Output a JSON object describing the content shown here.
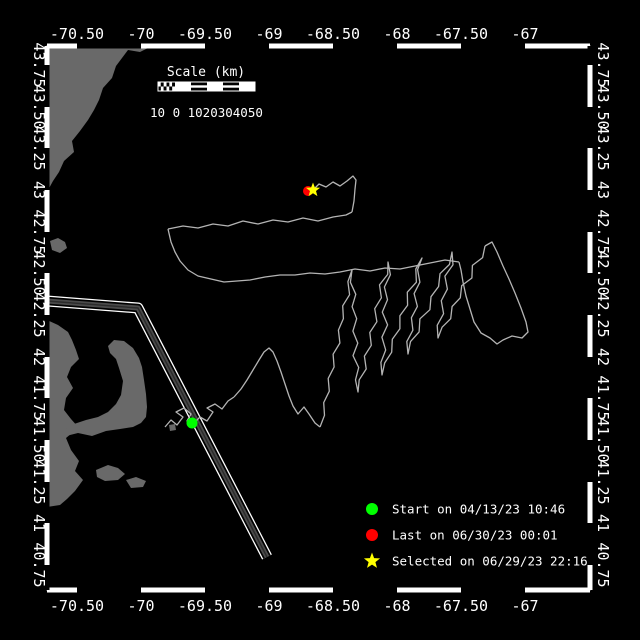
{
  "window": {
    "width": 640,
    "height": 640,
    "background": "#000000"
  },
  "frame": {
    "left": 47,
    "top": 46,
    "right": 590,
    "bottom": 590,
    "line_color": "#ffffff",
    "zebra_thickness": 5
  },
  "axes": {
    "lon_labels": [
      {
        "text": "-70.50",
        "x": 77
      },
      {
        "text": "-70",
        "x": 141
      },
      {
        "text": "-69.50",
        "x": 205
      },
      {
        "text": "-69",
        "x": 269
      },
      {
        "text": "-68.50",
        "x": 333
      },
      {
        "text": "-68",
        "x": 397
      },
      {
        "text": "-67.50",
        "x": 461
      },
      {
        "text": "-67",
        "x": 525
      }
    ],
    "lon_boundaries": [
      47,
      77,
      141,
      205,
      269,
      333,
      397,
      461,
      525,
      590
    ],
    "top_label_y": 39,
    "bottom_label_y": 611,
    "lat_labels": [
      {
        "text": "43.75",
        "y": 65
      },
      {
        "text": "43.50",
        "y": 107
      },
      {
        "text": "43.25",
        "y": 148
      },
      {
        "text": "43",
        "y": 190
      },
      {
        "text": "42.75",
        "y": 232
      },
      {
        "text": "42.50",
        "y": 273
      },
      {
        "text": "42.25",
        "y": 315
      },
      {
        "text": "42",
        "y": 357
      },
      {
        "text": "41.75",
        "y": 398
      },
      {
        "text": "41.50",
        "y": 440
      },
      {
        "text": "41.25",
        "y": 482
      },
      {
        "text": "41",
        "y": 523
      },
      {
        "text": "40.75",
        "y": 565
      }
    ],
    "lat_boundaries": [
      46,
      65,
      107,
      148,
      190,
      232,
      273,
      315,
      357,
      398,
      440,
      482,
      523,
      565,
      590
    ],
    "left_label_x": 34,
    "right_label_x": 598
  },
  "scalebar": {
    "title": "Scale (km)",
    "title_x": 206,
    "title_y": 76,
    "numbers": "10 0 1020304050",
    "numbers_x": 150,
    "numbers_y": 117,
    "x": 158,
    "y": 82,
    "width": 97,
    "height": 9,
    "checker_width": 17
  },
  "legend": {
    "marker_x": 372,
    "text_x": 392,
    "items": [
      {
        "marker": "circle",
        "color": "#00ff00",
        "label": "Start on 04/13/23 10:46",
        "y": 509
      },
      {
        "marker": "circle",
        "color": "#ff0000",
        "label": "Last on 06/30/23 00:01",
        "y": 535
      },
      {
        "marker": "star",
        "color": "#ffff00",
        "label": "Selected on 06/29/23 22:16",
        "y": 561
      }
    ]
  },
  "map": {
    "land_color": "#696969",
    "land_polygons": [
      [
        [
          47,
          46
        ],
        [
          152,
          46
        ],
        [
          140,
          52
        ],
        [
          128,
          50
        ],
        [
          122,
          58
        ],
        [
          116,
          66
        ],
        [
          112,
          78
        ],
        [
          103,
          88
        ],
        [
          99,
          100
        ],
        [
          94,
          110
        ],
        [
          88,
          120
        ],
        [
          80,
          131
        ],
        [
          72,
          141
        ],
        [
          74,
          152
        ],
        [
          64,
          161
        ],
        [
          59,
          172
        ],
        [
          53,
          181
        ],
        [
          47,
          192
        ]
      ],
      [
        [
          50,
          241
        ],
        [
          58,
          238
        ],
        [
          65,
          242
        ],
        [
          67,
          248
        ],
        [
          60,
          253
        ],
        [
          52,
          250
        ]
      ],
      [
        [
          47,
          320
        ],
        [
          58,
          325
        ],
        [
          68,
          332
        ],
        [
          72,
          340
        ],
        [
          76,
          350
        ],
        [
          79,
          359
        ],
        [
          71,
          367
        ],
        [
          67,
          377
        ],
        [
          73,
          388
        ],
        [
          66,
          398
        ],
        [
          64,
          410
        ],
        [
          71,
          419
        ],
        [
          79,
          428
        ],
        [
          72,
          433
        ],
        [
          66,
          438
        ],
        [
          71,
          450
        ],
        [
          79,
          461
        ],
        [
          75,
          471
        ],
        [
          83,
          480
        ],
        [
          75,
          491
        ],
        [
          67,
          499
        ],
        [
          60,
          505
        ],
        [
          47,
          507
        ]
      ],
      [
        [
          66,
          436
        ],
        [
          78,
          433
        ],
        [
          92,
          436
        ],
        [
          106,
          431
        ],
        [
          120,
          429
        ],
        [
          133,
          427
        ],
        [
          141,
          423
        ],
        [
          146,
          417
        ],
        [
          147,
          407
        ],
        [
          146,
          394
        ],
        [
          144,
          380
        ],
        [
          142,
          367
        ],
        [
          139,
          358
        ],
        [
          133,
          348
        ],
        [
          124,
          341
        ],
        [
          114,
          340
        ],
        [
          108,
          346
        ],
        [
          110,
          353
        ],
        [
          116,
          359
        ],
        [
          119,
          368
        ],
        [
          123,
          381
        ],
        [
          121,
          395
        ],
        [
          116,
          404
        ],
        [
          108,
          412
        ],
        [
          98,
          417
        ],
        [
          86,
          420
        ],
        [
          74,
          424
        ],
        [
          66,
          429
        ]
      ],
      [
        [
          96,
          470
        ],
        [
          108,
          465
        ],
        [
          118,
          468
        ],
        [
          125,
          474
        ],
        [
          118,
          480
        ],
        [
          105,
          481
        ],
        [
          97,
          477
        ]
      ],
      [
        [
          126,
          480
        ],
        [
          136,
          477
        ],
        [
          146,
          481
        ],
        [
          143,
          487
        ],
        [
          131,
          488
        ]
      ],
      [
        [
          169,
          425
        ],
        [
          175,
          424
        ],
        [
          176,
          430
        ],
        [
          170,
          431
        ]
      ]
    ],
    "shipping_lane": {
      "points": [
        [
          47,
          301
        ],
        [
          138,
          308
        ],
        [
          267,
          557
        ]
      ],
      "edge_color": "#ffffff",
      "fill_color": "#4a4a4a",
      "core_color": "#2b2b2b"
    },
    "markers": {
      "start": {
        "x": 192,
        "y": 423,
        "color": "#00ff00",
        "r": 5.5
      },
      "last": {
        "x": 308,
        "y": 191,
        "color": "#ff0000",
        "r": 5
      },
      "selected": {
        "x": 313,
        "y": 190,
        "color": "#ffff00",
        "r": 7.5
      }
    }
  },
  "track": {
    "color": "#b4b4b4",
    "width": 1.3,
    "segments": [
      {
        "amp": 2,
        "step": 9,
        "points": [
          [
            165,
            427
          ],
          [
            171,
            420
          ],
          [
            177,
            425
          ],
          [
            183,
            417
          ],
          [
            176,
            412
          ],
          [
            184,
            408
          ],
          [
            191,
            414
          ],
          [
            187,
            421
          ],
          [
            193,
            424
          ],
          [
            200,
            417
          ],
          [
            207,
            421
          ],
          [
            213,
            412
          ],
          [
            207,
            408
          ],
          [
            215,
            404
          ],
          [
            222,
            409
          ],
          [
            228,
            401
          ],
          [
            234,
            397
          ]
        ]
      },
      {
        "amp": 2,
        "step": 11,
        "points": [
          [
            234,
            397
          ],
          [
            241,
            389
          ],
          [
            247,
            380
          ],
          [
            253,
            370
          ],
          [
            259,
            360
          ],
          [
            264,
            352
          ],
          [
            269,
            348
          ],
          [
            273,
            352
          ],
          [
            277,
            361
          ],
          [
            281,
            372
          ],
          [
            285,
            384
          ],
          [
            289,
            396
          ],
          [
            293,
            406
          ],
          [
            298,
            414
          ],
          [
            304,
            407
          ],
          [
            309,
            414
          ],
          [
            315,
            423
          ],
          [
            320,
            427
          ]
        ]
      },
      {
        "amp": 2.5,
        "step": 12,
        "points": [
          [
            320,
            427
          ],
          [
            352,
            270
          ],
          [
            358,
            392
          ],
          [
            388,
            262
          ],
          [
            382,
            375
          ],
          [
            422,
            258
          ],
          [
            408,
            354
          ],
          [
            452,
            252
          ],
          [
            438,
            338
          ],
          [
            485,
            246
          ]
        ]
      },
      {
        "amp": 2.5,
        "step": 12,
        "points": [
          [
            485,
            246
          ],
          [
            492,
            242
          ],
          [
            497,
            252
          ],
          [
            503,
            266
          ],
          [
            509,
            279
          ],
          [
            515,
            293
          ],
          [
            521,
            308
          ],
          [
            526,
            322
          ],
          [
            528,
            332
          ],
          [
            522,
            338
          ],
          [
            512,
            336
          ],
          [
            503,
            340
          ],
          [
            497,
            344
          ],
          [
            490,
            338
          ],
          [
            481,
            333
          ],
          [
            474,
            322
          ],
          [
            470,
            309
          ],
          [
            466,
            296
          ],
          [
            463,
            282
          ],
          [
            461,
            270
          ],
          [
            459,
            262
          ]
        ]
      },
      {
        "amp": 3.2,
        "step": 13,
        "points": [
          [
            459,
            262
          ],
          [
            445,
            260
          ],
          [
            430,
            263
          ],
          [
            415,
            266
          ],
          [
            400,
            269
          ],
          [
            385,
            268
          ],
          [
            370,
            271
          ],
          [
            355,
            269
          ],
          [
            340,
            272
          ],
          [
            325,
            274
          ],
          [
            310,
            273
          ],
          [
            295,
            275
          ],
          [
            280,
            275
          ],
          [
            265,
            277
          ],
          [
            250,
            280
          ],
          [
            237,
            281
          ],
          [
            224,
            282
          ],
          [
            211,
            279
          ],
          [
            198,
            276
          ],
          [
            188,
            270
          ],
          [
            180,
            261
          ],
          [
            175,
            252
          ],
          [
            171,
            242
          ],
          [
            168,
            229
          ]
        ]
      },
      {
        "amp": 3.8,
        "step": 13,
        "points": [
          [
            168,
            229
          ],
          [
            183,
            226
          ],
          [
            198,
            228
          ],
          [
            213,
            224
          ],
          [
            228,
            226
          ],
          [
            243,
            221
          ],
          [
            258,
            224
          ],
          [
            273,
            220
          ],
          [
            288,
            222
          ],
          [
            303,
            218
          ],
          [
            318,
            221
          ],
          [
            333,
            217
          ],
          [
            346,
            215
          ],
          [
            352,
            212
          ]
        ]
      },
      {
        "amp": 2,
        "step": 10,
        "points": [
          [
            352,
            212
          ],
          [
            354,
            201
          ],
          [
            355,
            189
          ],
          [
            356,
            180
          ],
          [
            353,
            176
          ],
          [
            347,
            181
          ],
          [
            340,
            186
          ],
          [
            333,
            182
          ],
          [
            326,
            187
          ],
          [
            319,
            184
          ],
          [
            314,
            189
          ],
          [
            310,
            191
          ]
        ]
      }
    ]
  }
}
